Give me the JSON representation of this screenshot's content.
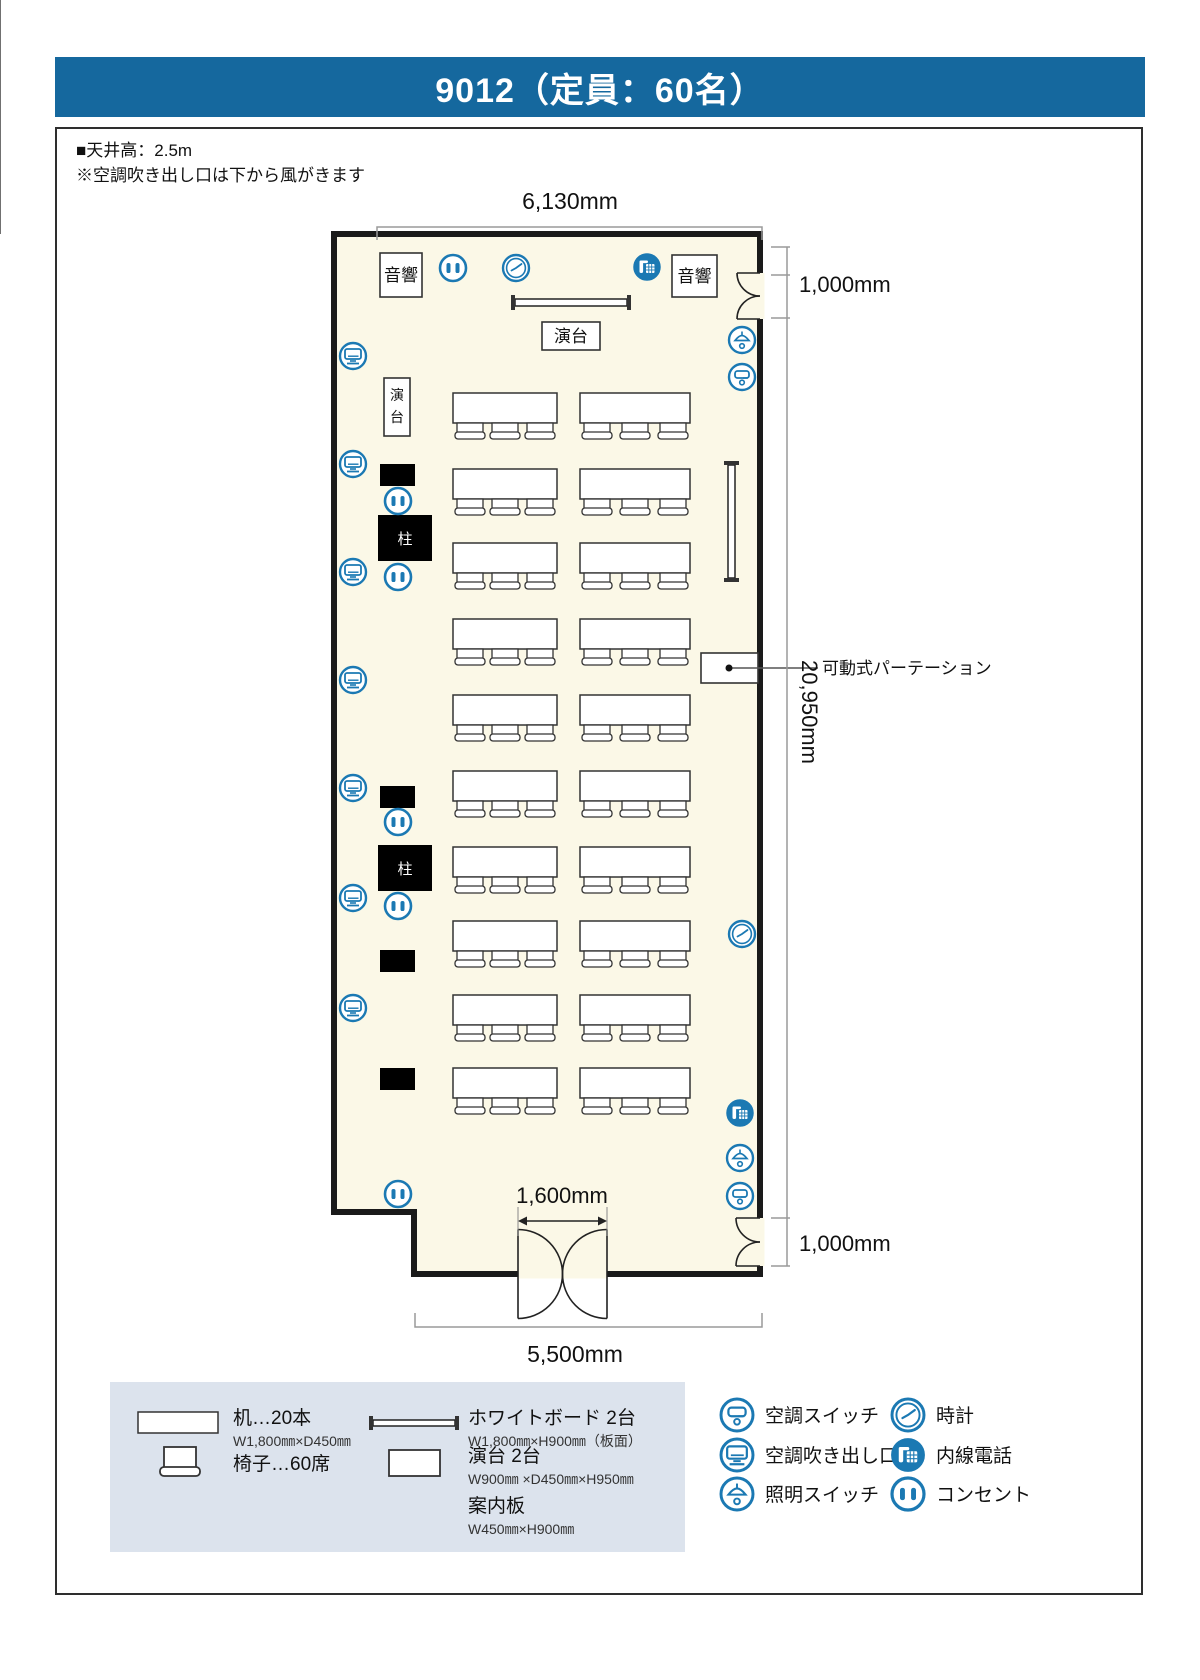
{
  "header": {
    "title": "9012（定員：60名）"
  },
  "notes": [
    "■天井高：2.5m",
    "※空調吹き出し口は下から風がきます"
  ],
  "colors": {
    "header_bg": "#15689E",
    "icon_blue": "#1B79B3",
    "room_fill": "#FBF8E7",
    "legend_bg": "#DCE3ED",
    "wall": "#1A1A1A",
    "line": "#2E2E2E",
    "dim": "#9A9A9A"
  },
  "dimensions": {
    "top": "6,130mm",
    "right_top": "1,000mm",
    "right_middle": "20,950mm",
    "right_bottom": "1,000mm",
    "door": "1,600mm",
    "bottom": "5,500mm"
  },
  "plan": {
    "labels": {
      "audio": "音響",
      "podium": "演台",
      "podium_chars": [
        "演",
        "台"
      ],
      "pillar": "柱",
      "partition": "可動式パーテーション"
    },
    "counts": {
      "desks": 20,
      "chairs": 60,
      "rows": 10,
      "tables_per_row": 2,
      "chairs_per_table": 3
    },
    "geo": {
      "room": {
        "x1": 334,
        "y1": 234,
        "x2": 760,
        "y2": 1274,
        "notch_x": 414,
        "notch_y": 1212,
        "inner_x": 377
      },
      "rows_y": [
        393,
        469,
        543,
        619,
        695,
        771,
        847,
        921,
        995,
        1068
      ],
      "table_h": 30,
      "tables_x": [
        [
          453,
          104
        ],
        [
          580,
          110
        ]
      ],
      "audio_boxes": [
        [
          380,
          253,
          42,
          44
        ],
        [
          672,
          255,
          45,
          42
        ]
      ],
      "podium_top": [
        542,
        322,
        58,
        28
      ],
      "podium_left": [
        384,
        378,
        26,
        58
      ],
      "pillars": [
        [
          378,
          515,
          54,
          46
        ],
        [
          378,
          845,
          54,
          46
        ]
      ],
      "signboards": [
        [
          380,
          464,
          35,
          22
        ],
        [
          380,
          786,
          35,
          22
        ],
        [
          380,
          950,
          35,
          22
        ],
        [
          380,
          1068,
          35,
          22
        ]
      ],
      "outlets": [
        [
          453,
          268
        ],
        [
          398,
          501
        ],
        [
          398,
          577
        ],
        [
          398,
          822
        ],
        [
          398,
          906
        ],
        [
          398,
          1194
        ]
      ],
      "vents": [
        [
          353,
          356
        ],
        [
          353,
          464
        ],
        [
          353,
          572
        ],
        [
          353,
          680
        ],
        [
          353,
          788
        ],
        [
          353,
          898
        ],
        [
          353,
          1008
        ]
      ],
      "clocks": [
        [
          516,
          268
        ],
        [
          742,
          934
        ]
      ],
      "phones": [
        [
          647,
          267
        ],
        [
          740,
          1113
        ]
      ],
      "lightswitches": [
        [
          742,
          340
        ],
        [
          740,
          1158
        ]
      ],
      "acswitches": [
        [
          742,
          377
        ],
        [
          740,
          1196
        ]
      ],
      "whiteboard_h": [
        515,
        299,
        112
      ],
      "whiteboard_v": [
        728,
        465,
        113
      ],
      "partition": [
        701,
        653,
        57,
        30
      ],
      "partition_callout": {
        "dot": [
          729,
          668
        ],
        "line_end": 818,
        "text_x": 822,
        "text_y": 674
      },
      "doors_right": [
        [
          273,
          319
        ],
        [
          1218,
          1266
        ]
      ],
      "door_bottom": [
        518,
        607
      ],
      "dim_top": {
        "y": 227,
        "x1": 377,
        "x2": 762,
        "tx": 570,
        "ty": 209
      },
      "dim_bottom": {
        "y": 1327,
        "x1": 415,
        "x2": 762,
        "tx": 575,
        "ty": 1362
      },
      "dim_right": {
        "x": 787,
        "ticks": [
          247,
          275,
          318,
          1218,
          1266
        ],
        "top_label": [
          799,
          292
        ],
        "bottom_label": [
          799,
          1251
        ],
        "mid_label": [
          802,
          712
        ]
      },
      "dim_door": {
        "tx": 562,
        "ty": 1203,
        "arrow_y": 1221,
        "x1": 518,
        "x2": 607
      }
    }
  },
  "legend": {
    "items_furniture": [
      {
        "icon": "desk",
        "label": "机…20本",
        "sub": "W1,800㎜×D450㎜"
      },
      {
        "icon": "chair",
        "label": "椅子…60席",
        "sub": ""
      },
      {
        "icon": "whiteboard",
        "label": "ホワイトボード 2台",
        "sub": "W1,800㎜×H900㎜（板面）"
      },
      {
        "icon": "podium",
        "label": "演台 2台",
        "sub": "W900㎜ ×D450㎜×H950㎜"
      },
      {
        "icon": "none",
        "label": "案内板",
        "sub": "W450㎜×H900㎜"
      }
    ],
    "items_icons": [
      {
        "icon": "acswitch",
        "label": "空調スイッチ"
      },
      {
        "icon": "vent",
        "label": "空調吹き出し口"
      },
      {
        "icon": "lightswitch",
        "label": "照明スイッチ"
      },
      {
        "icon": "clock",
        "label": "時計"
      },
      {
        "icon": "phone",
        "label": "内線電話"
      },
      {
        "icon": "outlet",
        "label": "コンセント"
      }
    ]
  }
}
